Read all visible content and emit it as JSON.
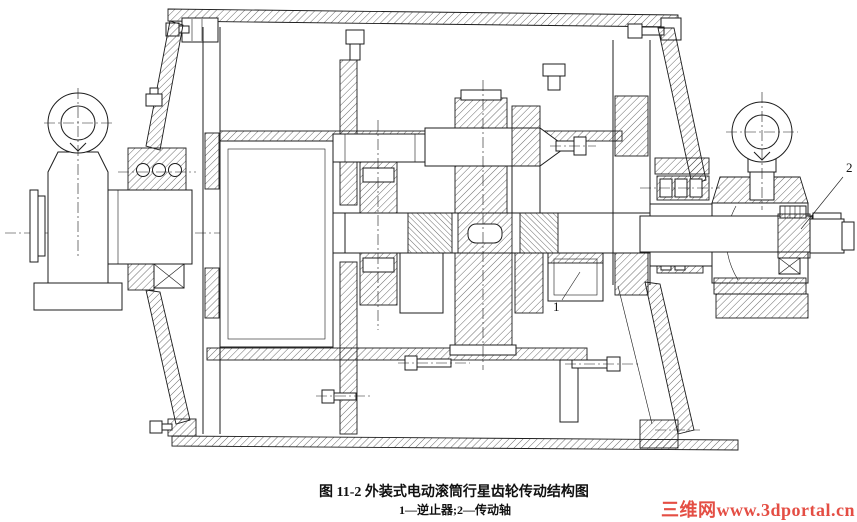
{
  "figure": {
    "caption": "图 11-2  外装式电动滚筒行星齿轮传动结构图",
    "legend": "1—逆止器;2—传动轴",
    "callouts": {
      "c1": "1",
      "c2": "2"
    },
    "watermark": "三维网www.3dportal.cn"
  },
  "colors": {
    "line": "#1c1c1c",
    "watermark": "#e23b30",
    "background": "#ffffff"
  }
}
